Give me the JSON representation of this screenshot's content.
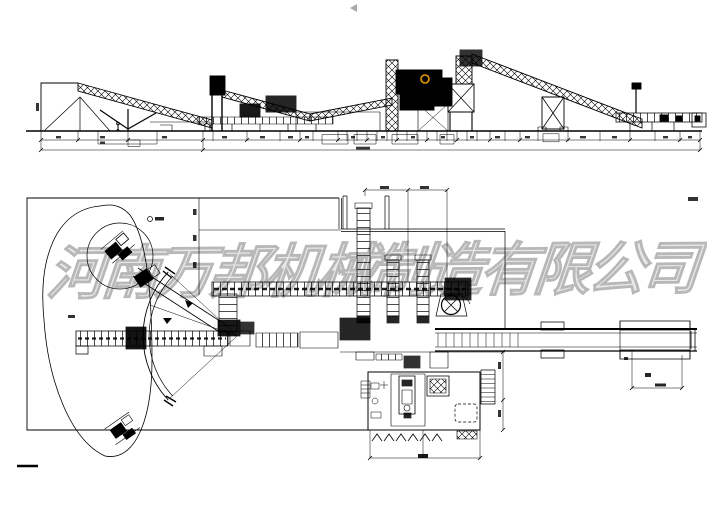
{
  "colors": {
    "background": "#ffffff",
    "line": "#000000",
    "watermark": "#b8b8b8",
    "accent": "#e89b00",
    "cursor": "#9a9a9a"
  },
  "watermark": {
    "text": "河南万邦机械制造有限公司"
  },
  "cursor": {
    "glyph": "left-pointing-cursor"
  }
}
